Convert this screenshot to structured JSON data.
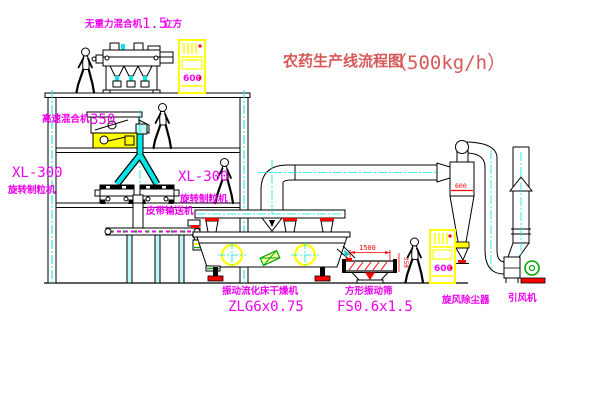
{
  "title": {
    "main": "农药生产线流程图",
    "capacity": "（500kg/h）"
  },
  "labels": {
    "gravity_mixer_name": "无重力混合机",
    "gravity_mixer_size": "1.5",
    "gravity_mixer_unit": "立方",
    "hs_mixer_name": "高速混合机",
    "hs_mixer_model": "350",
    "granulator_left_model": "XL-300",
    "granulator_left_name": "旋转制粒机",
    "granulator_right_model": "XL-300",
    "granulator_right_name": "旋转制粒机",
    "belt_conveyor": "皮带输送机",
    "dryer_name": "振动流化床干燥机",
    "dryer_model": "ZLG6x0.75",
    "screen_name": "方形振动筛",
    "screen_model": "FS0.6x1.5",
    "cyclone_name": "旋风除尘器",
    "fan_name": "引风机"
  },
  "annotations": {
    "cyclone_mark": "600",
    "screen_dim_length": "1500",
    "screen_dim_height": "350",
    "cabinet_top_mark": "600",
    "cabinet_right_mark": "600"
  },
  "colors": {
    "label_magenta": "#ee00ee",
    "title_red": "#d85858",
    "detail_red": "#ff0000",
    "pipe_cyan": "#00e5e5",
    "equipment_yellow": "#ffff00",
    "accent_green": "#00a800",
    "line_black": "#000000"
  }
}
